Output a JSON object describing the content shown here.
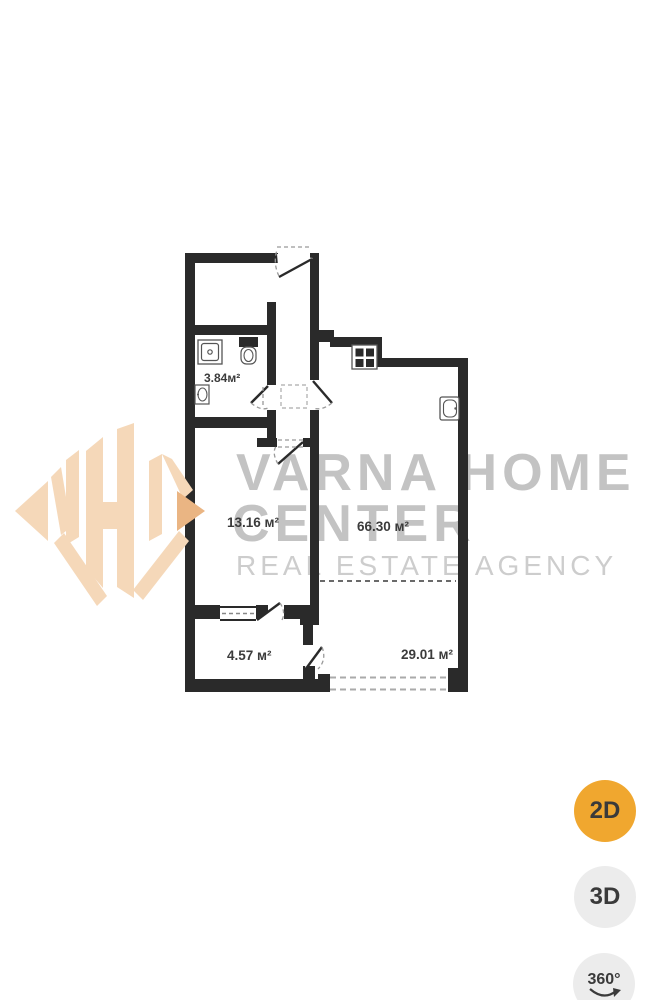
{
  "floor_plan": {
    "wall_color": "#2a2a2a",
    "label_color": "#3b3b3b",
    "rooms": [
      {
        "name": "bathroom",
        "area": "3.84м²"
      },
      {
        "name": "hall-room",
        "area": "13.16 м²"
      },
      {
        "name": "living-kitchen-room",
        "area": "66.30 м²"
      },
      {
        "name": "balcony",
        "area": "4.57 м²"
      },
      {
        "name": "terrace",
        "area": "29.01 м²"
      }
    ]
  },
  "watermark": {
    "line1": "VARNA HOME",
    "line2": "CENTER",
    "tagline": "REAL ESTATE AGENCY",
    "title_color": "#c3c3c3",
    "tagline_color": "#cdcdcd"
  },
  "logo": {
    "color": "#f5d8b9",
    "accent_color": "#eab583"
  },
  "view_buttons": {
    "btn_2d": {
      "label": "2D",
      "active": true,
      "background": "#f0a72f"
    },
    "btn_3d": {
      "label": "3D",
      "active": false,
      "background": "#ececec"
    },
    "btn_360": {
      "label": "360°",
      "active": false,
      "background": "#ececec"
    }
  }
}
